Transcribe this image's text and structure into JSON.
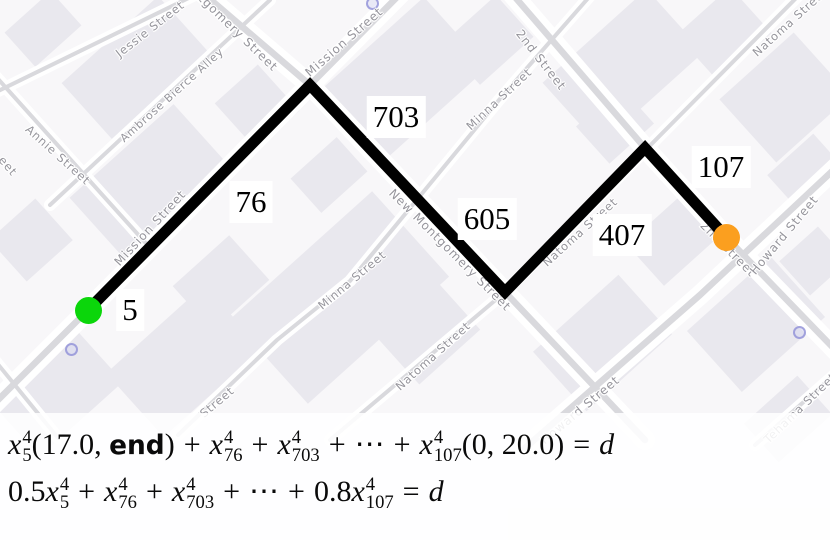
{
  "map": {
    "background": "#f8f7f9",
    "building_color": "#e9e8ee",
    "street_casing_color": "#ffffff",
    "street_core_color": "#d9d9dd",
    "label_color": "#96959c",
    "streets": [
      {
        "name": "jessie-street",
        "main": false,
        "path": [
          [
            -10,
            95
          ],
          [
            205,
            -10
          ]
        ]
      },
      {
        "name": "ambrose-bierce-alley",
        "main": false,
        "path": [
          [
            50,
            205
          ],
          [
            270,
            0
          ]
        ]
      },
      {
        "name": "annie-street",
        "main": false,
        "path": [
          [
            -10,
            70
          ],
          [
            152,
            250
          ]
        ]
      },
      {
        "name": "mission-street",
        "main": true,
        "path": [
          [
            -20,
            418
          ],
          [
            88,
            310
          ],
          [
            310,
            85
          ],
          [
            412,
            -18
          ]
        ]
      },
      {
        "name": "minna-street",
        "main": false,
        "path": [
          [
            178,
            435
          ],
          [
            277,
            340
          ],
          [
            350,
            281
          ],
          [
            499,
            100
          ],
          [
            597,
            -12
          ]
        ]
      },
      {
        "name": "natoma-street",
        "main": false,
        "path": [
          [
            330,
            440
          ],
          [
            505,
            292
          ],
          [
            812,
            -18
          ]
        ]
      },
      {
        "name": "new-montgomery-street",
        "main": true,
        "path": [
          [
            190,
            -18
          ],
          [
            310,
            85
          ],
          [
            505,
            292
          ],
          [
            645,
            440
          ]
        ]
      },
      {
        "name": "second-street",
        "main": true,
        "path": [
          [
            502,
            -18
          ],
          [
            645,
            148
          ],
          [
            726,
            237
          ],
          [
            845,
            360
          ]
        ]
      },
      {
        "name": "howard-street",
        "main": true,
        "path": [
          [
            525,
            448
          ],
          [
            700,
            295
          ],
          [
            842,
            162
          ]
        ]
      },
      {
        "name": "tehama-street",
        "main": false,
        "path": [
          [
            755,
            445
          ],
          [
            842,
            368
          ]
        ]
      },
      {
        "name": "sw-corner-street",
        "main": false,
        "path": [
          [
            -12,
            352
          ],
          [
            58,
            438
          ]
        ]
      }
    ],
    "buildings": [
      {
        "x": 70,
        "y": 30,
        "w": 130,
        "h": 75,
        "r": -42
      },
      {
        "x": 12,
        "y": 6,
        "w": 62,
        "h": 46,
        "r": -42
      },
      {
        "x": 228,
        "y": 76,
        "w": 58,
        "h": 62,
        "r": -42
      },
      {
        "x": 80,
        "y": 140,
        "w": 140,
        "h": 85,
        "r": -42
      },
      {
        "x": 0,
        "y": 212,
        "w": 62,
        "h": 56,
        "r": -42
      },
      {
        "x": 325,
        "y": 35,
        "w": 150,
        "h": 95,
        "r": -42
      },
      {
        "x": 452,
        "y": 12,
        "w": 72,
        "h": 56,
        "r": -42
      },
      {
        "x": 298,
        "y": 152,
        "w": 62,
        "h": 46,
        "r": -42
      },
      {
        "x": 553,
        "y": 25,
        "w": 140,
        "h": 85,
        "r": -42
      },
      {
        "x": 688,
        "y": 3,
        "w": 72,
        "h": 62,
        "r": -42
      },
      {
        "x": 735,
        "y": 55,
        "w": 100,
        "h": 85,
        "r": -42
      },
      {
        "x": 585,
        "y": 100,
        "w": 60,
        "h": 50,
        "r": -42
      },
      {
        "x": 776,
        "y": 148,
        "w": 62,
        "h": 50,
        "r": -42
      },
      {
        "x": 245,
        "y": 240,
        "w": 190,
        "h": 115,
        "r": -42
      },
      {
        "x": 388,
        "y": 303,
        "w": 82,
        "h": 62,
        "r": -42
      },
      {
        "x": 183,
        "y": 253,
        "w": 76,
        "h": 60,
        "r": -42
      },
      {
        "x": 0,
        "y": 353,
        "w": 112,
        "h": 76,
        "r": -42
      },
      {
        "x": 118,
        "y": 318,
        "w": 132,
        "h": 86,
        "r": -42
      },
      {
        "x": 545,
        "y": 303,
        "w": 115,
        "h": 80,
        "r": -42
      },
      {
        "x": 636,
        "y": 213,
        "w": 72,
        "h": 56,
        "r": -42
      },
      {
        "x": 700,
        "y": 283,
        "w": 112,
        "h": 82,
        "r": -42
      },
      {
        "x": 788,
        "y": 238,
        "w": 52,
        "h": 46,
        "r": -42
      },
      {
        "x": 752,
        "y": 393,
        "w": 72,
        "h": 52,
        "r": -42
      }
    ],
    "street_labels": [
      {
        "text": "Jessie Street",
        "x": 150,
        "y": 29,
        "rot": -38,
        "size": 11.5
      },
      {
        "text": "Montgomery Street",
        "x": 228,
        "y": 23,
        "rot": 44,
        "size": 12
      },
      {
        "text": "Ambrose Bierce Alley",
        "x": 172,
        "y": 95,
        "rot": -42,
        "size": 11
      },
      {
        "text": "Annie Street",
        "x": 58,
        "y": 155,
        "rot": 42,
        "size": 11.5
      },
      {
        "text": "eet",
        "x": 8,
        "y": 166,
        "rot": 50,
        "size": 11.5
      },
      {
        "text": "Mission Street",
        "x": 344,
        "y": 42,
        "rot": -41,
        "size": 12
      },
      {
        "text": "Minna Street",
        "x": 499,
        "y": 99,
        "rot": -43,
        "size": 11.5
      },
      {
        "text": "2nd Street",
        "x": 541,
        "y": 60,
        "rot": 52,
        "size": 12
      },
      {
        "text": "Natoma Street",
        "x": 790,
        "y": 22,
        "rot": -42,
        "size": 11.5
      },
      {
        "text": "Mission Street",
        "x": 150,
        "y": 228,
        "rot": -47,
        "size": 12
      },
      {
        "text": "New Montgomery Street",
        "x": 450,
        "y": 250,
        "rot": 45,
        "size": 12
      },
      {
        "text": "Minna Street",
        "x": 352,
        "y": 280,
        "rot": -40,
        "size": 11.5
      },
      {
        "text": "Street",
        "x": 217,
        "y": 402,
        "rot": -40,
        "size": 11.5
      },
      {
        "text": "Natoma Street",
        "x": 433,
        "y": 356,
        "rot": -42,
        "size": 11.5
      },
      {
        "text": "Natoma Street",
        "x": 580,
        "y": 232,
        "rot": -42,
        "size": 11.5
      },
      {
        "text": "2nd Street",
        "x": 728,
        "y": 249,
        "rot": 45,
        "size": 12
      },
      {
        "text": "Howard Street",
        "x": 784,
        "y": 235,
        "rot": -50,
        "size": 12
      },
      {
        "text": "Howard Street",
        "x": 580,
        "y": 410,
        "rot": -40,
        "size": 12
      },
      {
        "text": "Tehama Street",
        "x": 800,
        "y": 408,
        "rot": -44,
        "size": 11.5
      }
    ],
    "pois": [
      {
        "x": 71,
        "y": 349
      },
      {
        "x": 799,
        "y": 332
      },
      {
        "x": 372,
        "y": 3
      }
    ]
  },
  "route": {
    "color": "#000000",
    "width": 11,
    "points": [
      [
        88,
        310
      ],
      [
        310,
        85
      ],
      [
        505,
        292
      ],
      [
        645,
        148
      ],
      [
        726,
        237
      ]
    ],
    "start_marker": {
      "x": 88,
      "y": 310,
      "r": 13.5,
      "color": "#0bd60b"
    },
    "end_marker": {
      "x": 726,
      "y": 237,
      "r": 13.5,
      "color": "#fb9f1f"
    },
    "edge_labels": [
      {
        "text": "5",
        "x": 130,
        "y": 310
      },
      {
        "text": "76",
        "x": 251,
        "y": 202
      },
      {
        "text": "703",
        "x": 396,
        "y": 117
      },
      {
        "text": "605",
        "x": 487,
        "y": 219
      },
      {
        "text": "407",
        "x": 622,
        "y": 235
      },
      {
        "text": "107",
        "x": 721,
        "y": 167
      }
    ]
  },
  "equations": {
    "lines": [
      [
        {
          "t": "var",
          "b": "x",
          "sup": "4",
          "sub": "5"
        },
        {
          "t": "txt",
          "s": "(17.0, "
        },
        {
          "t": "sf",
          "s": "end"
        },
        {
          "t": "txt",
          "s": ")"
        },
        {
          "t": "op",
          "s": "+"
        },
        {
          "t": "var",
          "b": "x",
          "sup": "4",
          "sub": "76"
        },
        {
          "t": "op",
          "s": "+"
        },
        {
          "t": "var",
          "b": "x",
          "sup": "4",
          "sub": "703"
        },
        {
          "t": "op",
          "s": "+"
        },
        {
          "t": "txt",
          "s": "⋯"
        },
        {
          "t": "op",
          "s": "+"
        },
        {
          "t": "var",
          "b": "x",
          "sup": "4",
          "sub": "107"
        },
        {
          "t": "txt",
          "s": "(0, 20.0)"
        },
        {
          "t": "op",
          "s": "="
        },
        {
          "t": "it",
          "s": "d"
        }
      ],
      [
        {
          "t": "txt",
          "s": "0.5"
        },
        {
          "t": "var",
          "b": "x",
          "sup": "4",
          "sub": "5"
        },
        {
          "t": "op",
          "s": "+"
        },
        {
          "t": "var",
          "b": "x",
          "sup": "4",
          "sub": "76"
        },
        {
          "t": "op",
          "s": "+"
        },
        {
          "t": "var",
          "b": "x",
          "sup": "4",
          "sub": "703"
        },
        {
          "t": "op",
          "s": "+"
        },
        {
          "t": "txt",
          "s": "⋯"
        },
        {
          "t": "op",
          "s": "+"
        },
        {
          "t": "txt",
          "s": "0.8"
        },
        {
          "t": "var",
          "b": "x",
          "sup": "4",
          "sub": "107"
        },
        {
          "t": "op",
          "s": "="
        },
        {
          "t": "it",
          "s": "d"
        }
      ]
    ]
  }
}
